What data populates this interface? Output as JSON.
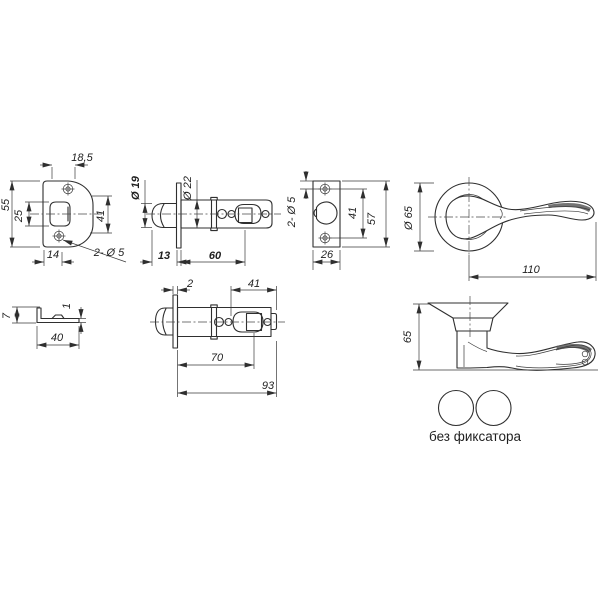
{
  "ink": "#2f2f2f",
  "drawing": {
    "strike_plate_front": {
      "width_top": "18,5",
      "height": "55",
      "cutout_height": "25",
      "side_height": "41",
      "width_bottom": "14",
      "holes": "2- Ø 5"
    },
    "latch_top_view": {
      "bolt_diameter": "Ø 19",
      "tube_diameter": "Ø 22",
      "head_length": "13",
      "tube_length": "60"
    },
    "faceplate_front": {
      "holes": "2- Ø 5",
      "hole_spacing": "41",
      "height": "57",
      "width": "26"
    },
    "handle_front": {
      "rose_diameter": "Ø 65",
      "lever_length": "110"
    },
    "strike_plate_side": {
      "lip_height": "7",
      "thickness": "1",
      "length": "40"
    },
    "latch_side_view": {
      "faceplate_thickness": "2",
      "tip_length": "41",
      "backset": "70",
      "total_length": "93"
    },
    "handle_side": {
      "height": "65"
    },
    "variant": {
      "label": "без фиксатора"
    }
  }
}
